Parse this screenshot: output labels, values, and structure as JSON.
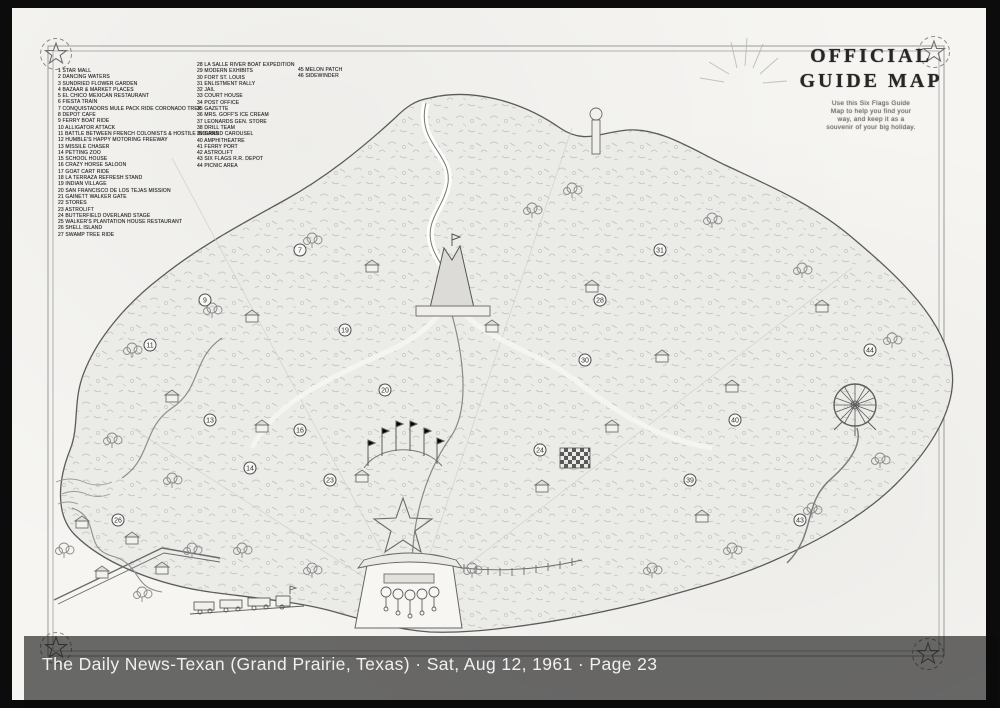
{
  "viewer": {
    "caption": "The Daily News-Texan (Grand Prairie, Texas) · Sat, Aug 12, 1961 · Page 23"
  },
  "map": {
    "title_lines": [
      "OFFICIAL",
      "GUIDE MAP"
    ],
    "subtitle_lines": [
      "Use this Six Flags Guide",
      "Map to help you find your",
      "way, and keep it as a",
      "souvenir of your big holiday."
    ],
    "legend": {
      "column1": [
        "1 STAR MALL",
        "2 DANCING WATERS",
        "3 SUNDRIED FLOWER GARDEN",
        "4 BAZAAR & MARKET PLACES",
        "5 EL CHICO MEXICAN RESTAURANT",
        "6 FIESTA TRAIN",
        "7 CONQUISTADORS MULE PACK RIDE CORONADO TREK",
        "8 DEPOT CAFE",
        "9 FERRY BOAT RIDE",
        "10 ALLIGATOR ATTACK",
        "11 BATTLE BETWEEN FRENCH COLONISTS & HOSTILE INDIANS",
        "12 HUMBLE'S HAPPY MOTORING FREEWAY",
        "13 MISSILE CHASER",
        "14 PETTING ZOO",
        "15 SCHOOL HOUSE",
        "16 CRAZY HORSE SALOON",
        "17 GOAT CART RIDE",
        "18 LA TERRAZA REFRESH STAND",
        "19 INDIAN VILLAGE",
        "20 SAN FRANCISCO DE LOS TEJAS MISSION",
        "21 GAINETT WALKER GATE",
        "22 STORES",
        "23 ASTROLIFT",
        "24 BUTTERFIELD OVERLAND STAGE",
        "25 WALKER'S PLANTATION HOUSE RESTAURANT",
        "26 SHELL ISLAND",
        "27 SWAMP TREE RIDE"
      ],
      "column2": [
        "28 LA SALLE RIVER BOAT EXPEDITION",
        "29 MODERN EXHIBITS",
        "30 FORT ST. LOUIS",
        "31 ENLISTMENT RALLY",
        "32 JAIL",
        "33 COURT HOUSE",
        "34 POST OFFICE",
        "35 GAZETTE",
        "36 MRS. GOFF'S ICE CREAM",
        "37 LEONARDS GEN. STORE",
        "38 DRILL TEAM",
        "39 GRAND CAROUSEL",
        "40 AMPHITHEATRE",
        "41 FERRY PORT",
        "42 ASTROLIFT",
        "43 SIX FLAGS R.R. DEPOT",
        "44 PICNIC AREA"
      ],
      "column3": [
        "45 MELON PATCH",
        "46 SIDEWINDER"
      ]
    },
    "markers": [
      {
        "n": "7",
        "x": 288,
        "y": 242
      },
      {
        "n": "9",
        "x": 193,
        "y": 292
      },
      {
        "n": "11",
        "x": 138,
        "y": 337
      },
      {
        "n": "13",
        "x": 198,
        "y": 412
      },
      {
        "n": "14",
        "x": 238,
        "y": 460
      },
      {
        "n": "16",
        "x": 288,
        "y": 422
      },
      {
        "n": "19",
        "x": 333,
        "y": 322
      },
      {
        "n": "20",
        "x": 373,
        "y": 382
      },
      {
        "n": "23",
        "x": 318,
        "y": 472
      },
      {
        "n": "24",
        "x": 528,
        "y": 442
      },
      {
        "n": "26",
        "x": 106,
        "y": 512
      },
      {
        "n": "28",
        "x": 588,
        "y": 292
      },
      {
        "n": "30",
        "x": 573,
        "y": 352
      },
      {
        "n": "31",
        "x": 648,
        "y": 242
      },
      {
        "n": "39",
        "x": 678,
        "y": 472
      },
      {
        "n": "40",
        "x": 723,
        "y": 412
      },
      {
        "n": "43",
        "x": 788,
        "y": 512
      },
      {
        "n": "44",
        "x": 858,
        "y": 342
      }
    ]
  },
  "colors": {
    "frame": "#0c0c0c",
    "page": "#f6f5f2",
    "park_fill": "#ebebe8",
    "ink": "#4c4c4c",
    "overlay": "rgba(10,10,10,0.60)",
    "caption_text": "#f0f0f0"
  }
}
